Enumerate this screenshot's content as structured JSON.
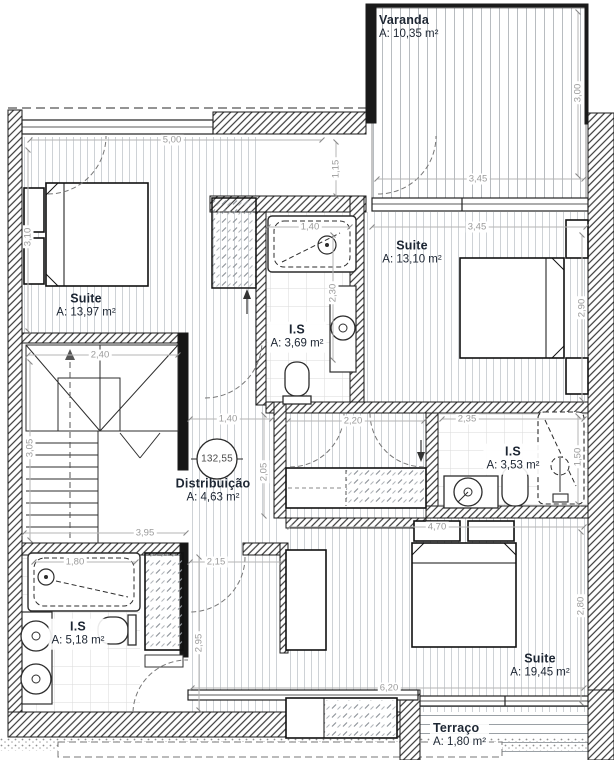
{
  "drawing_type": "architectural-floor-plan",
  "rooms": {
    "varanda": {
      "name": "Varanda",
      "area": "A: 10,35 m²"
    },
    "suite_top_left": {
      "name": "Suite",
      "area": "A: 13,97 m²"
    },
    "suite_top_right": {
      "name": "Suite",
      "area": "A: 13,10 m²"
    },
    "is_center": {
      "name": "I.S",
      "area": "A: 3,69 m²"
    },
    "distribuicao": {
      "name": "Distribuição",
      "area": "A: 4,63 m²"
    },
    "is_right": {
      "name": "I.S",
      "area": "A: 3,53 m²"
    },
    "suite_bottom": {
      "name": "Suite",
      "area": "A: 19,45 m²"
    },
    "is_bottom_left": {
      "name": "I.S",
      "area": "A: 5,18 m²"
    },
    "terraco": {
      "name": "Terraço",
      "area": "A: 1,80 m²"
    }
  },
  "level_marker": {
    "value": "132,55"
  },
  "dims": {
    "top_left_width": "5,00",
    "suite_tl_height": "3,10",
    "varanda_width": "3,45",
    "varanda_depth": "3,00",
    "suite_tr_width": "3,45",
    "suite_tr_height": "2,90",
    "bath_center_width": "1,40",
    "bath_center_height": "2,30",
    "opening_top": "1,15",
    "stair_width": "2,40",
    "stair_height": "3,05",
    "dist_width": "1,40",
    "corridor_top": "2,20",
    "dist_height": "2,05",
    "is_right_width": "2,35",
    "is_right_height": "1,50",
    "suite_b_width": "4,70",
    "suite_b_height": "2,80",
    "bottom_left_width": "3,95",
    "tub_width": "1,80",
    "door_opening": "2,15",
    "corridor_height": "2,95",
    "bottom_width": "6,20"
  },
  "colors": {
    "label_text": "#1d2633",
    "dimension_text": "#9b9b9b",
    "wall_line": "#1a1a1a",
    "floor_hatch": "#ced2d6"
  }
}
